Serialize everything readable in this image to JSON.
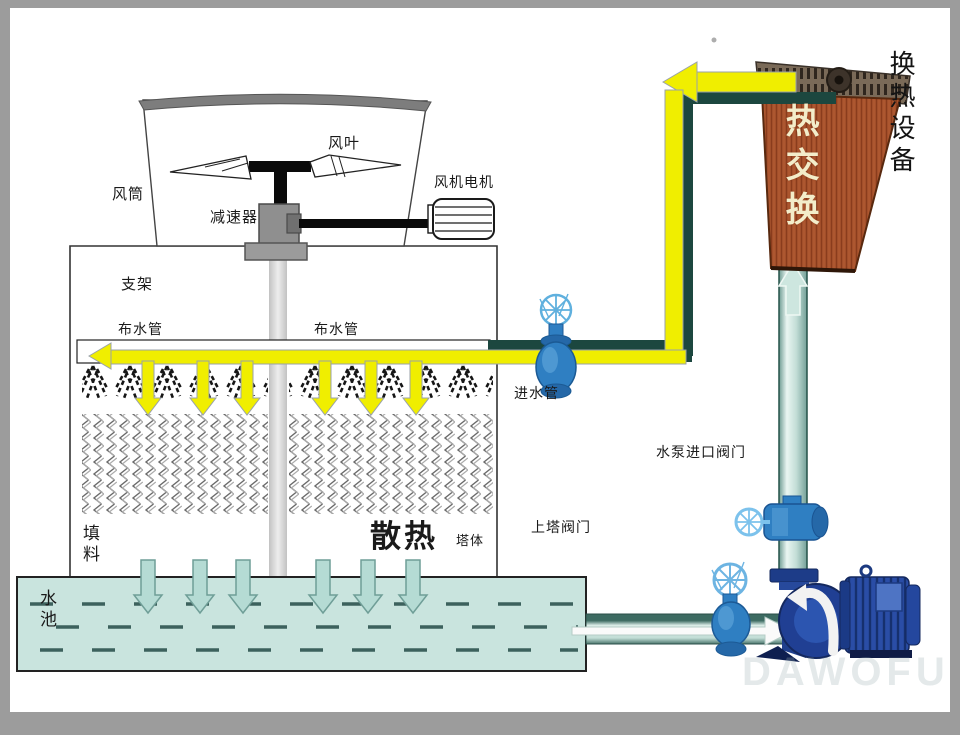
{
  "labels": {
    "fan_blade": "风叶",
    "fan_duct": "风筒",
    "reducer": "减速器",
    "fan_motor": "风机电机",
    "support": "支架",
    "water_dist_left": "布水管",
    "water_dist_right": "布水管",
    "inlet_pipe": "进水管",
    "pump_inlet_valve": "水泵进口阀门",
    "tower_valve": "上塔阀门",
    "fill_material": "填料",
    "heat_dissipation": "散热",
    "tower_body": "塔体",
    "water_pool": "水池",
    "heat_exchange": "热交换",
    "heat_exchange_equipment": "换热设备"
  },
  "watermark": "DAWOFU",
  "colors": {
    "pipe_yellow": "#f0ee00",
    "pipe_dark_teal": "#1c473f",
    "pipe_light_teal": "#c2ddd6",
    "pool_fill": "#c9e4de",
    "pool_dash": "#3c615d",
    "exchanger_body": "#ad5730",
    "pump_blue": "#203f93",
    "valve_blue": "#2f7fc2",
    "frame_gray": "#9c9c9c",
    "hot_text": "#f3edca"
  }
}
